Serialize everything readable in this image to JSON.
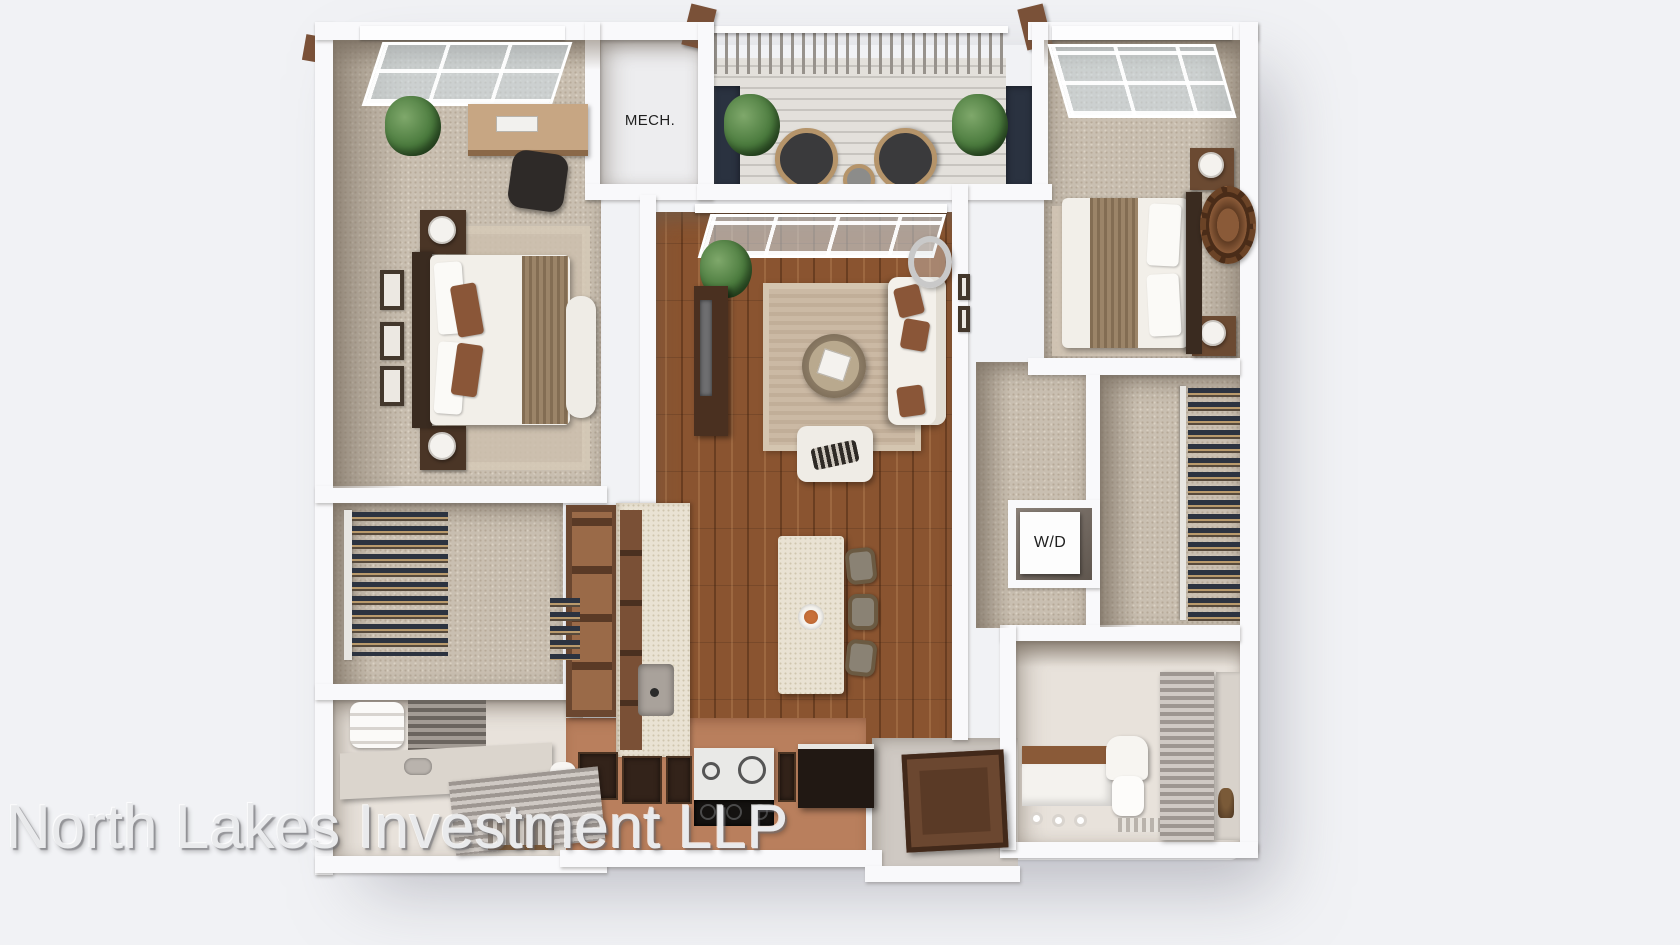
{
  "labels": {
    "mech_room": "MECH.",
    "washer_dryer": "W/D"
  },
  "watermark": {
    "text": "North Lakes Investment LLP"
  },
  "colors": {
    "background": "#f1f2f5",
    "wall": "#f9f9fb",
    "carpet": "#c9bfb1",
    "wood_floor": "#8a5430",
    "accent_navy": "#2a3240",
    "kitchen_terracotta": "#b97f5d",
    "balcony_deck": "#dedbd6",
    "bathroom_tile": "#e8e2db"
  }
}
